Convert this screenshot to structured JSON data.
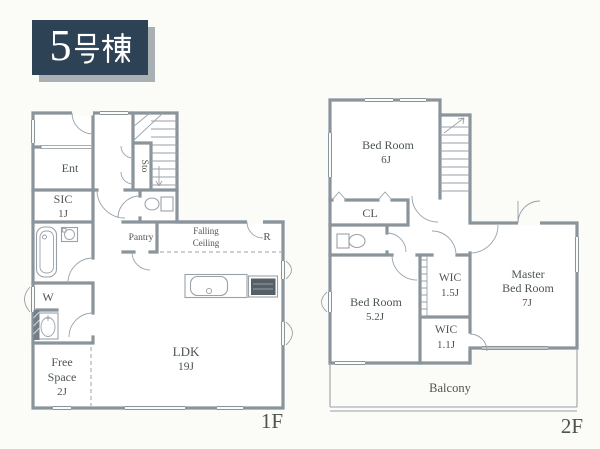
{
  "title": {
    "full": "5号棟",
    "number": "5",
    "suffix": "号棟"
  },
  "floor1": {
    "floor_label": "1F",
    "entrance": "Ent",
    "sic": "SIC",
    "sic_size": "1J",
    "storage": "Sto",
    "pantry": "Pantry",
    "falling_ceiling_line1": "Falling",
    "falling_ceiling_line2": "Ceiling",
    "refrigerator": "R",
    "washroom": "W",
    "free_space_line1": "Free",
    "free_space_line2": "Space",
    "free_space_size": "2J",
    "ldk": "LDK",
    "ldk_size": "19J"
  },
  "floor2": {
    "floor_label": "2F",
    "bedroom6": "Bed Room",
    "bedroom6_size": "6J",
    "closet": "CL",
    "bedroom5": "Bed Room",
    "bedroom5_size": "5.2J",
    "wic_a": "WIC",
    "wic_a_size": "1.5J",
    "wic_b": "WIC",
    "wic_b_size": "1.1J",
    "master_line1": "Master",
    "master_line2": "Bed Room",
    "master_size": "7J",
    "balcony": "Balcony"
  },
  "colors": {
    "wall": "#8a949b",
    "thin": "#9aa2a8",
    "text": "#4d564e",
    "title_bg": "#2e4255",
    "title_shadow": "#a9b0b4",
    "page_bg": "#fbfbf8",
    "fixture_dark": "#575f66"
  }
}
